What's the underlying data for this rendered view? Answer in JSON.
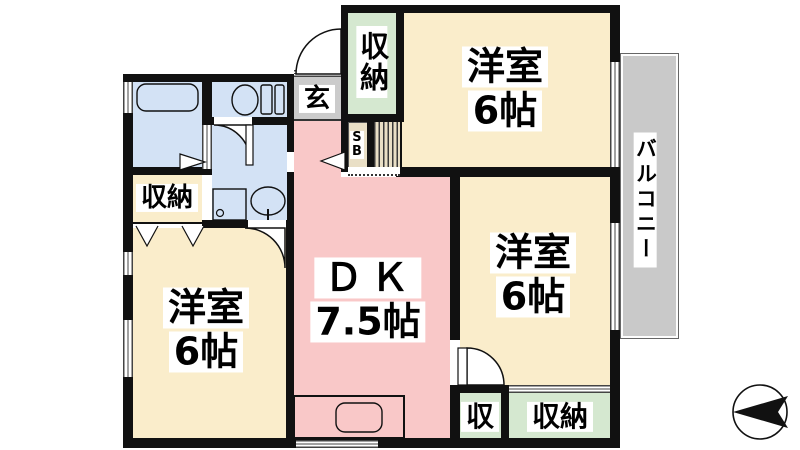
{
  "plan_title": "3DK apartment floor plan",
  "rooms": [
    {
      "id": "room-top-right",
      "name": "洋室",
      "size": "6帖"
    },
    {
      "id": "room-middle-right",
      "name": "洋室",
      "size": "6帖"
    },
    {
      "id": "room-bottom-left",
      "name": "洋室",
      "size": "6帖"
    },
    {
      "id": "dining-kitchen",
      "name": "ＤＫ",
      "size": "7.5帖"
    }
  ],
  "storage": {
    "closet_top": "収納",
    "closet_left": "収納",
    "closet_bottom_small": "収",
    "closet_bottom": "収納"
  },
  "entrance": {
    "label": "玄"
  },
  "shoe_box": {
    "line1": "S",
    "line2": "B"
  },
  "balcony": {
    "label": "バルコニー"
  },
  "icons": [
    "bathtub-icon",
    "toilet-icon",
    "washbasin-icon",
    "washing-machine-icon",
    "kitchen-sink-icon",
    "compass-north-icon",
    "door-swing-arc"
  ],
  "colors": {
    "room": "#faedcb",
    "dining_kitchen": "#f9c8c8",
    "storage": "#d5e8d0",
    "water_area": "#d3e2f5",
    "entrance": "#cbcbcb",
    "balcony": "#c9c9c9",
    "shoe_box": "#e9dfc6",
    "wall": "#111111"
  }
}
